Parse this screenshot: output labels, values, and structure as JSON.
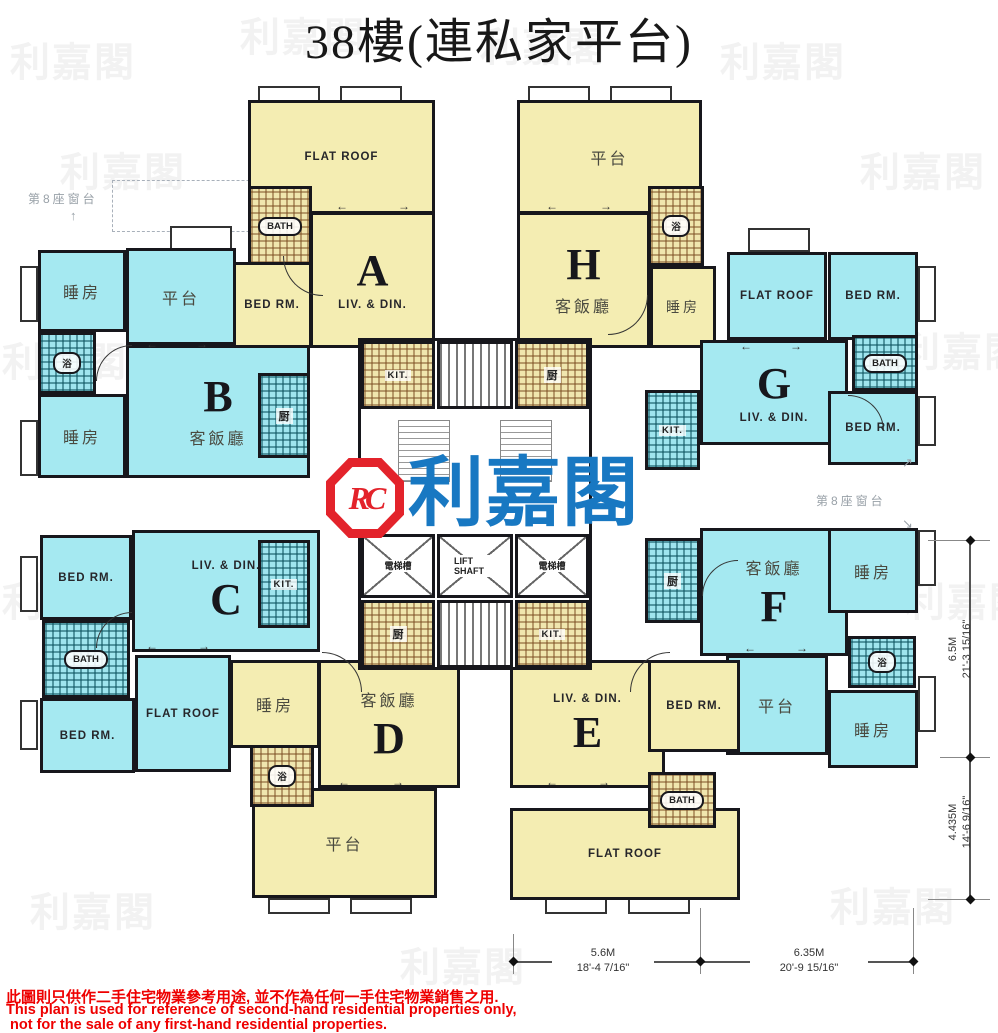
{
  "title": "38樓(連私家平台)",
  "logo": {
    "monogram": "RC",
    "brand": "利嘉閣"
  },
  "watermark": "利嘉閣",
  "icons": {
    "arrow_left": "←",
    "arrow_right": "→",
    "arrow_up": "↑",
    "arrow_up_right": "↗",
    "arrow_down_right": "↘"
  },
  "annotations": {
    "bay_window_left": "第8座窗台",
    "bay_window_right": "第8座窗台"
  },
  "core": {
    "kit_a": "KIT.",
    "kit_h": "厨",
    "kit_b": "厨",
    "kit_c": "KIT.",
    "kit_g": "KIT.",
    "kit_f": "厨",
    "kit_d": "厨",
    "kit_e": "KIT.",
    "lift_left": "電梯槽",
    "lift_shaft": "LIFT SHAFT",
    "lift_right": "電梯槽"
  },
  "units": {
    "A": {
      "letter": "A",
      "flat_roof": "FLAT ROOF",
      "bath": "BATH",
      "bed": "BED RM.",
      "living": "LIV. & DIN."
    },
    "H": {
      "letter": "H",
      "terrace": "平台",
      "living": "客飯廳",
      "bath": "浴",
      "bed": "睡房"
    },
    "B": {
      "letter": "B",
      "bed_top": "睡房",
      "terrace": "平台",
      "bath": "浴",
      "living": "客飯廳",
      "bed_bottom": "睡房"
    },
    "G": {
      "letter": "G",
      "flat_roof": "FLAT ROOF",
      "bed_top": "BED RM.",
      "bath": "BATH",
      "living": "LIV. & DIN.",
      "bed_bottom": "BED RM."
    },
    "C": {
      "letter": "C",
      "bed_top": "BED RM.",
      "living": "LIV. & DIN.",
      "bath": "BATH",
      "bed_bottom": "BED RM.",
      "flat_roof": "FLAT ROOF"
    },
    "F": {
      "letter": "F",
      "living": "客飯廳",
      "bed_top": "睡房",
      "bath": "浴",
      "terrace": "平台",
      "bed_bottom": "睡房"
    },
    "D": {
      "letter": "D",
      "bed": "睡房",
      "living": "客飯廳",
      "bath": "浴",
      "terrace": "平台"
    },
    "E": {
      "letter": "E",
      "living": "LIV. & DIN.",
      "bed": "BED RM.",
      "bath": "BATH",
      "flat_roof": "FLAT ROOF"
    }
  },
  "dimensions": {
    "right_upper_m": "6.5M",
    "right_upper_ft": "21'-3 15/16\"",
    "right_lower_m": "4.435M",
    "right_lower_ft": "14'-6 9/16\"",
    "bottom_left_m": "5.6M",
    "bottom_left_ft": "18'-4 7/16\"",
    "bottom_right_m": "6.35M",
    "bottom_right_ft": "20'-9 15/16\""
  },
  "disclaimer": {
    "zh": "此圖則只供作二手住宅物業參考用途, 並不作為任何一手住宅物業銷售之用.",
    "en_line1": "This plan is used for reference of second-hand residential properties only,",
    "en_line2": "not for the sale of any first-hand residential properties."
  },
  "colors": {
    "unit_yellow": "#f4edb2",
    "unit_blue": "#a5e9f1",
    "logo_red": "#e3232b",
    "logo_blue": "#1878c2",
    "disclaimer_red": "#ee0000"
  }
}
